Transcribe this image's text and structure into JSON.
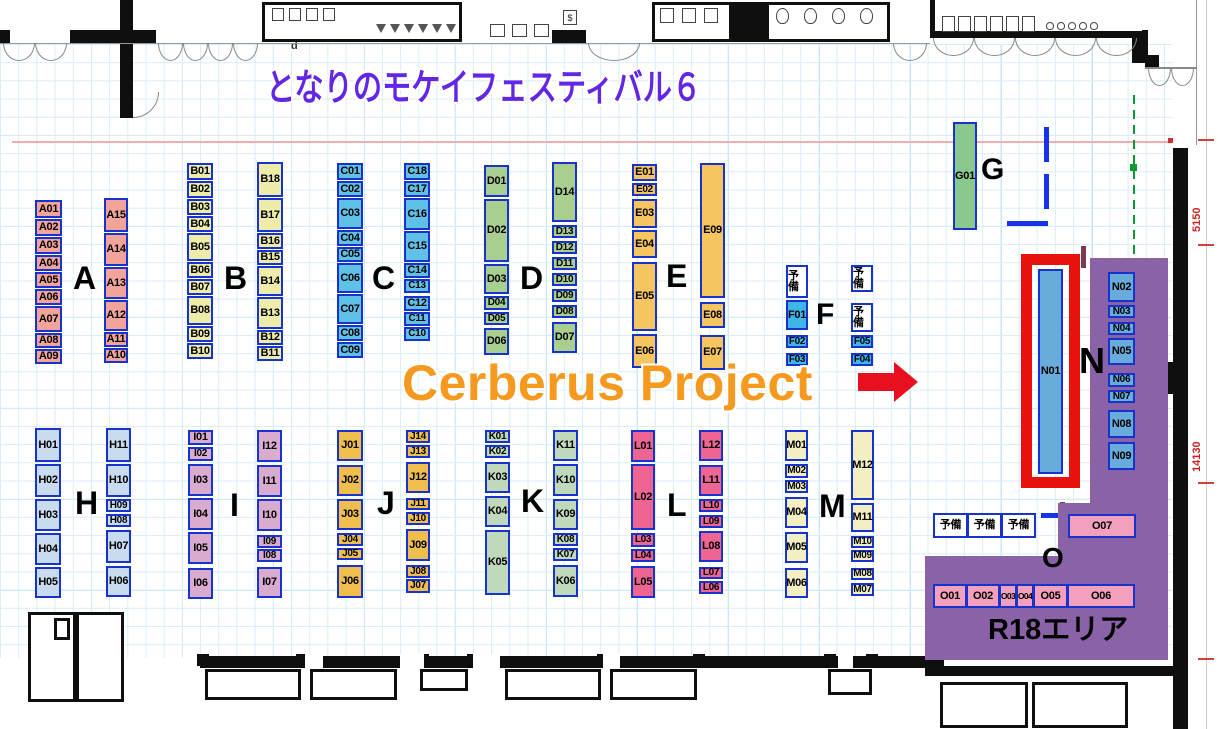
{
  "title": {
    "text": "となりのモケイフェスティバル６",
    "color": "#6227E4"
  },
  "highlight": {
    "label": "Cerberus Project",
    "color": "#F59A1F",
    "arrow_color": "#E8101E",
    "target_booth": "N01"
  },
  "labels": {
    "reserve": "予備",
    "r18": "R18エリア"
  },
  "annotations": {
    "door_d": "d",
    "elevator": "$",
    "stall_5s": "5$",
    "dim_5150": "5150",
    "dim_14130": "14130",
    "dim_850": "850,"
  },
  "colors": {
    "booth_border": "#1733CB",
    "highlight_frame": "#E8110E",
    "r18_area": "#8A62A8",
    "wall": "#0f0f0f",
    "n_booth": "#68ACDC",
    "o_booth": "#F2A0BE"
  },
  "n01": {
    "id": "N01",
    "x": 1038,
    "y": 269,
    "w": 25,
    "h": 205,
    "frame": {
      "x": 1021,
      "y": 254,
      "w": 59,
      "h": 234,
      "t": 11
    }
  },
  "o_area": {
    "letter": "O",
    "lx": 1042,
    "ly": 544,
    "lfs": 28,
    "reserves": {
      "x": 933,
      "y": 513,
      "w": 35,
      "h": 25,
      "count": 3
    },
    "o07": {
      "id": "O07",
      "x": 1068,
      "y": 514,
      "w": 68,
      "h": 24
    },
    "row": {
      "x": 933,
      "y": 584,
      "h": 24,
      "booths": [
        [
          "O01",
          34
        ],
        [
          "O02",
          34
        ],
        [
          "O03",
          18
        ],
        [
          "O04",
          18
        ],
        [
          "O05",
          35
        ],
        [
          "O06",
          68
        ]
      ]
    },
    "r18_pos": {
      "x": 988,
      "y": 616,
      "fs": 29
    }
  },
  "r18_rects": [
    [
      1090,
      258,
      78,
      251
    ],
    [
      1058,
      503,
      110,
      57
    ],
    [
      925,
      556,
      243,
      104
    ]
  ],
  "columns": [
    {
      "letter": "A",
      "color": "#F2A49A",
      "lx": 73,
      "ly": 262,
      "lfs": 32,
      "subs": [
        {
          "x": 35,
          "y": 200,
          "w": 27,
          "gap": 1,
          "booths": [
            [
              "A01",
              18
            ],
            [
              "A02",
              17
            ],
            [
              "A03",
              17
            ],
            [
              "A04",
              16
            ],
            [
              "A05",
              16
            ],
            [
              "A06",
              16
            ],
            [
              "A07",
              26
            ],
            [
              "A08",
              15
            ],
            [
              "A09",
              15
            ]
          ]
        },
        {
          "x": 104,
          "y": 198,
          "w": 24,
          "gap": 1,
          "booths": [
            [
              "A15",
              34
            ],
            [
              "A14",
              33
            ],
            [
              "A13",
              32
            ],
            [
              "A12",
              31
            ],
            [
              "A11",
              15
            ],
            [
              "A10",
              15
            ]
          ]
        }
      ]
    },
    {
      "letter": "B",
      "color": "#EDEDA9",
      "lx": 224,
      "ly": 262,
      "lfs": 32,
      "subs": [
        {
          "x": 187,
          "y": 163,
          "w": 26,
          "gap": 1,
          "booths": [
            [
              "B01",
              17
            ],
            [
              "B02",
              17
            ],
            [
              "B03",
              16
            ],
            [
              "B04",
              16
            ],
            [
              "B05",
              28
            ],
            [
              "B06",
              16
            ],
            [
              "B07",
              16
            ],
            [
              "B08",
              29
            ],
            [
              "B09",
              16
            ],
            [
              "B10",
              16
            ]
          ]
        },
        {
          "x": 257,
          "y": 162,
          "w": 26,
          "gap": 1,
          "booths": [
            [
              "B18",
              35
            ],
            [
              "B17",
              34
            ],
            [
              "B16",
              16
            ],
            [
              "B15",
              15
            ],
            [
              "B14",
              30
            ],
            [
              "B13",
              32
            ],
            [
              "B12",
              15
            ],
            [
              "B11",
              15
            ]
          ]
        }
      ]
    },
    {
      "letter": "C",
      "color": "#5FC0E8",
      "lx": 372,
      "ly": 262,
      "lfs": 32,
      "subs": [
        {
          "x": 337,
          "y": 163,
          "w": 26,
          "gap": 1,
          "booths": [
            [
              "C01",
              17
            ],
            [
              "C02",
              16
            ],
            [
              "C03",
              31
            ],
            [
              "C04",
              16
            ],
            [
              "C05",
              15
            ],
            [
              "C06",
              30
            ],
            [
              "C07",
              30
            ],
            [
              "C08",
              16
            ],
            [
              "C09",
              16
            ]
          ]
        },
        {
          "x": 404,
          "y": 163,
          "w": 26,
          "gap": 1,
          "booths": [
            [
              "C18",
              17
            ],
            [
              "C17",
              16
            ],
            [
              "C16",
              32
            ],
            [
              "C15",
              31
            ],
            [
              "C14",
              15
            ],
            [
              "C13",
              14
            ],
            [
              "C12",
              15,
              3
            ],
            [
              "C11",
              14
            ],
            [
              "C10",
              14
            ]
          ]
        }
      ]
    },
    {
      "letter": "D",
      "color": "#A9CF90",
      "lx": 520,
      "ly": 262,
      "lfs": 32,
      "subs": [
        {
          "x": 484,
          "y": 165,
          "w": 25,
          "gap": 2,
          "booths": [
            [
              "D01",
              32
            ],
            [
              "D02",
              63
            ],
            [
              "D03",
              30
            ],
            [
              "D04",
              14
            ],
            [
              "D05",
              13
            ],
            [
              "D06",
              27,
              3
            ]
          ]
        },
        {
          "x": 552,
          "y": 162,
          "w": 25,
          "gap": 3,
          "booths": [
            [
              "D14",
              60
            ],
            [
              "D13",
              13
            ],
            [
              "D12",
              13
            ],
            [
              "D11",
              13
            ],
            [
              "D10",
              13
            ],
            [
              "D09",
              13
            ],
            [
              "D08",
              13
            ],
            [
              "D07",
              31,
              4
            ]
          ]
        }
      ]
    },
    {
      "letter": "E",
      "color": "#F5C55F",
      "lx": 666,
      "ly": 260,
      "lfs": 32,
      "subs": [
        {
          "x": 632,
          "y": 164,
          "w": 25,
          "gap": 2,
          "booths": [
            [
              "E01",
              17
            ],
            [
              "E02",
              13
            ],
            [
              "E03",
              29,
              3
            ],
            [
              "E04",
              28
            ],
            [
              "E05",
              69,
              4
            ],
            [
              "E06",
              34,
              3
            ]
          ]
        },
        {
          "x": 700,
          "y": 163,
          "w": 25,
          "gap": 4,
          "booths": [
            [
              "E09",
              135
            ],
            [
              "E08",
              26
            ],
            [
              "E07",
              35,
              7
            ]
          ]
        }
      ]
    },
    {
      "letter": "F",
      "color": "#3FB6EA",
      "lx": 816,
      "ly": 300,
      "lfs": 30,
      "subs": [
        {
          "x": 786,
          "y": 265,
          "w": 22,
          "gap": 3,
          "booths": [
            [
              "予備",
              33,
              null,
              1
            ],
            [
              "F01",
              30,
              2
            ],
            [
              "F02",
              13,
              5
            ],
            [
              "F03",
              13,
              5
            ]
          ]
        },
        {
          "x": 851,
          "y": 265,
          "w": 22,
          "gap": 3,
          "booths": [
            [
              "予備",
              27,
              null,
              1
            ],
            [
              "予備",
              29,
              11,
              1
            ],
            [
              "F05",
              13
            ],
            [
              "F04",
              13,
              5
            ]
          ]
        }
      ]
    },
    {
      "letter": "G",
      "color": "#8BC88E",
      "lx": 981,
      "ly": 155,
      "lfs": 30,
      "subs": [
        {
          "x": 953,
          "y": 122,
          "w": 24,
          "gap": 0,
          "booths": [
            [
              "G01",
              108
            ]
          ]
        }
      ]
    },
    {
      "letter": "H",
      "color": "#C9DCEF",
      "lx": 75,
      "ly": 487,
      "lfs": 32,
      "subs": [
        {
          "x": 35,
          "y": 428,
          "w": 26,
          "gap": 2,
          "booths": [
            [
              "H01",
              34
            ],
            [
              "H02",
              33
            ],
            [
              "H03",
              32
            ],
            [
              "H04",
              32
            ],
            [
              "H05",
              31
            ]
          ]
        },
        {
          "x": 106,
          "y": 428,
          "w": 25,
          "gap": 2,
          "booths": [
            [
              "H11",
              34
            ],
            [
              "H10",
              33
            ],
            [
              "H09",
              13
            ],
            [
              "H08",
              13
            ],
            [
              "H07",
              33,
              3
            ],
            [
              "H06",
              31,
              3
            ]
          ]
        }
      ]
    },
    {
      "letter": "I",
      "color": "#D9ABCF",
      "lx": 230,
      "ly": 489,
      "lfs": 32,
      "subs": [
        {
          "x": 188,
          "y": 430,
          "w": 25,
          "gap": 2,
          "booths": [
            [
              "I01",
              15
            ],
            [
              "I02",
              14
            ],
            [
              "I03",
              32,
              3
            ],
            [
              "I04",
              32
            ],
            [
              "I05",
              32
            ],
            [
              "I06",
              31,
              4
            ]
          ]
        },
        {
          "x": 257,
          "y": 430,
          "w": 25,
          "gap": 2,
          "booths": [
            [
              "I12",
              32
            ],
            [
              "I11",
              32,
              3
            ],
            [
              "I10",
              32
            ],
            [
              "I09",
              13,
              4
            ],
            [
              "I08",
              13,
              1
            ],
            [
              "I07",
              31,
              5
            ]
          ]
        }
      ]
    },
    {
      "letter": "J",
      "color": "#EFBE4C",
      "lx": 377,
      "ly": 487,
      "lfs": 32,
      "subs": [
        {
          "x": 337,
          "y": 430,
          "w": 26,
          "gap": 3,
          "booths": [
            [
              "J01",
              31
            ],
            [
              "J02",
              31,
              4
            ],
            [
              "J03",
              31
            ],
            [
              "J04",
              13
            ],
            [
              "J05",
              12,
              2
            ],
            [
              "J06",
              33,
              5
            ]
          ]
        },
        {
          "x": 406,
          "y": 430,
          "w": 24,
          "gap": 2,
          "booths": [
            [
              "J14",
              13
            ],
            [
              "J13",
              13
            ],
            [
              "J12",
              31,
              4
            ],
            [
              "J11",
              12,
              5
            ],
            [
              "J10",
              13
            ],
            [
              "J09",
              32,
              4
            ],
            [
              "J08",
              13,
              4
            ],
            [
              "J07",
              14,
              1
            ]
          ]
        }
      ]
    },
    {
      "letter": "K",
      "color": "#BFD9BA",
      "lx": 521,
      "ly": 485,
      "lfs": 32,
      "subs": [
        {
          "x": 485,
          "y": 430,
          "w": 25,
          "gap": 3,
          "booths": [
            [
              "K01",
              13
            ],
            [
              "K02",
              13,
              2
            ],
            [
              "K03",
              31,
              4
            ],
            [
              "K04",
              31
            ],
            [
              "K05",
              65
            ]
          ]
        },
        {
          "x": 553,
          "y": 430,
          "w": 25,
          "gap": 3,
          "booths": [
            [
              "K11",
              31
            ],
            [
              "K10",
              32
            ],
            [
              "K09",
              31
            ],
            [
              "K08",
              13
            ],
            [
              "K07",
              13,
              2
            ],
            [
              "K06",
              32,
              4
            ]
          ]
        }
      ]
    },
    {
      "letter": "L",
      "color": "#EE6492",
      "lx": 667,
      "ly": 489,
      "lfs": 32,
      "subs": [
        {
          "x": 631,
          "y": 430,
          "w": 24,
          "gap": 2,
          "booths": [
            [
              "L01",
              32
            ],
            [
              "L02",
              66
            ],
            [
              "L03",
              14,
              3
            ],
            [
              "L04",
              13
            ],
            [
              "L05",
              32,
              4
            ]
          ]
        },
        {
          "x": 699,
          "y": 430,
          "w": 24,
          "gap": 3,
          "booths": [
            [
              "L12",
              31
            ],
            [
              "L11",
              31,
              4
            ],
            [
              "L10",
              13
            ],
            [
              "L09",
              13
            ],
            [
              "L08",
              31
            ],
            [
              "L07",
              12,
              5
            ],
            [
              "L06",
              13,
              2
            ]
          ]
        }
      ]
    },
    {
      "letter": "M",
      "color": "#F2EFC2",
      "lx": 819,
      "ly": 490,
      "lfs": 32,
      "subs": [
        {
          "x": 785,
          "y": 430,
          "w": 23,
          "gap": 3,
          "booths": [
            [
              "M01",
              31
            ],
            [
              "M02",
              14
            ],
            [
              "M03",
              13,
              2
            ],
            [
              "M04",
              31,
              4
            ],
            [
              "M05",
              31,
              4
            ],
            [
              "M06",
              30,
              5
            ]
          ]
        },
        {
          "x": 851,
          "y": 430,
          "w": 23,
          "gap": 3,
          "booths": [
            [
              "M12",
              70
            ],
            [
              "M11",
              29
            ],
            [
              "M10",
              12,
              4
            ],
            [
              "M09",
              12,
              2
            ],
            [
              "M08",
              12,
              6
            ],
            [
              "M07",
              13
            ]
          ]
        }
      ]
    },
    {
      "letter": "N",
      "color": "#68ACDC",
      "lx": 1079,
      "ly": 343,
      "lfs": 36,
      "subs": [
        {
          "x": 1108,
          "y": 272,
          "w": 27,
          "gap": 3,
          "booths": [
            [
              "N02",
              30
            ],
            [
              "N03",
              13
            ],
            [
              "N04",
              13,
              4
            ],
            [
              "N05",
              27
            ],
            [
              "N06",
              14,
              8
            ],
            [
              "N07",
              13
            ],
            [
              "N08",
              28,
              7
            ],
            [
              "N09",
              28,
              4
            ]
          ]
        }
      ]
    }
  ]
}
